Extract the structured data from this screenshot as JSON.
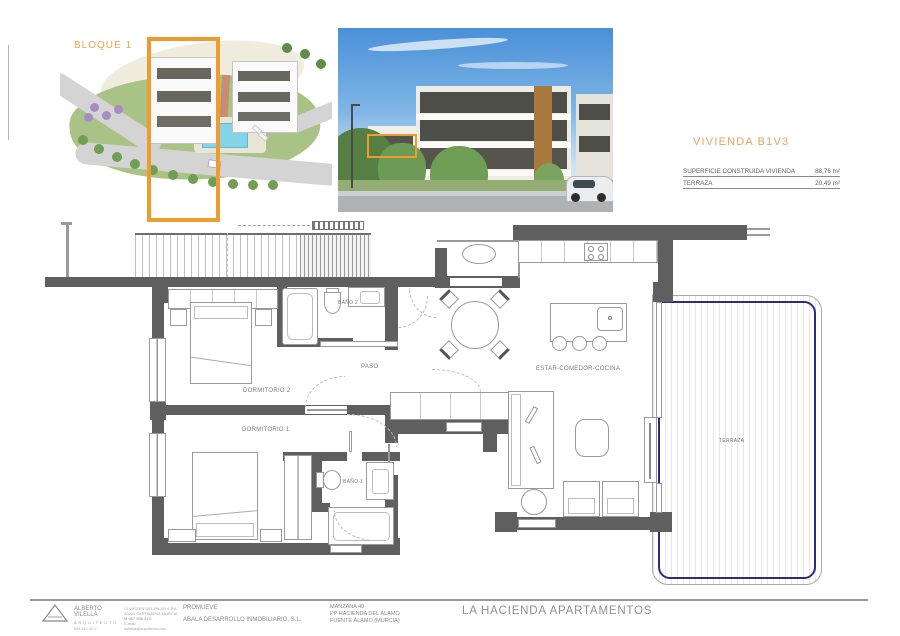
{
  "site_plan": {
    "block_label": "BLOQUE 1"
  },
  "unit_info": {
    "title": "VIVIENDA B1V3",
    "rows": [
      {
        "label": "SUPERFICIE CONSTRUIDA VIVIENDA",
        "value": "88,76 m²"
      },
      {
        "label": "TERRAZA",
        "value": "20,49 m²"
      }
    ]
  },
  "floor_plan": {
    "labels": {
      "dormitorio_1": "DORMITORIO 1",
      "dormitorio_2": "DORMITORIO 2",
      "bano_1": "BAÑO 1",
      "bano_2": "BAÑO 2",
      "paso": "PASO",
      "estar_comedor_cocina": "ESTAR-COMEDOR-COCINA",
      "terraza": "TERRAZA"
    }
  },
  "title_block": {
    "architect_name": "ALBERTO VILELLA",
    "architect_title": "ARQUITECTO",
    "architect_reg": "696 512 42 V",
    "contact_lines": [
      "C/ VIRGEN DEL PILAR 4 3ºA",
      "30201 CARTAGENA MURCIA",
      "M 967 958 213",
      "E-mail: avilella@arquitecto.com"
    ],
    "promoter_label": "PROMUEVE",
    "promoter_name": "ABALA DESARROLLO INMOBILIARIO, S.L.",
    "location_lines": [
      "MANZANA 49",
      "PP HACIENDA DEL ÁLAMO",
      "FUENTE ÁLAMO (MURCIA)"
    ],
    "project_title": "LA HACIENDA APARTAMENTOS"
  },
  "colors": {
    "accent_orange": "#EE9B30",
    "navy": "#2b2b80",
    "wall_gray": "#5f5f5f"
  }
}
